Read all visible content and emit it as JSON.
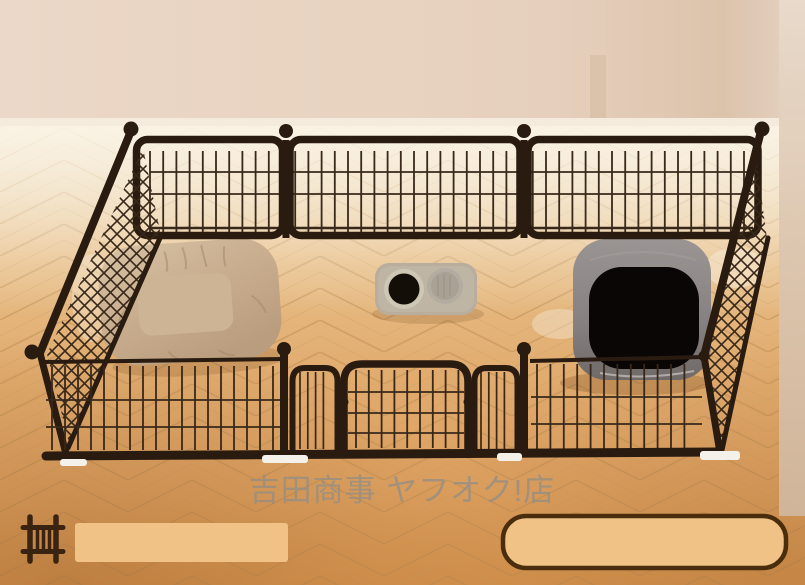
{
  "watermark": {
    "text": "吉田商事 ヤフオク!店",
    "color": "#8f8d88"
  },
  "footer": {
    "icon": "pet-fence-icon",
    "icon_color": "#3a2310",
    "banner_fill": "#f0c285",
    "banner_border": "#4a2d0c"
  },
  "scene_colors": {
    "wall": "#e9d4c2",
    "wall_shade": "#dcc3ac",
    "baseboard": "#f4ebdd",
    "curtain_top": "#e9dacb",
    "curtain_bottom": "#d0b69c",
    "floor_top": "#f1e2c8",
    "floor_mid": "#e4b077",
    "floor_bottom": "#d4924d",
    "floor_seam": "#bb8c52",
    "fence": "#2a1b10",
    "fence_mesh": "#38281a",
    "fence_foot": "#f4f1ea",
    "cushion": "#c9ae8f",
    "cushion_inner": "#cdb495",
    "cushion_crease": "#a4886a",
    "tray": "#b9ae9d",
    "bowl_rim": "#cfc7b6",
    "bowl_dark": "#140e09",
    "bowl_empty": "#a8a194",
    "litter_box": "#8e8887",
    "litter_opening": "#0a0605"
  }
}
